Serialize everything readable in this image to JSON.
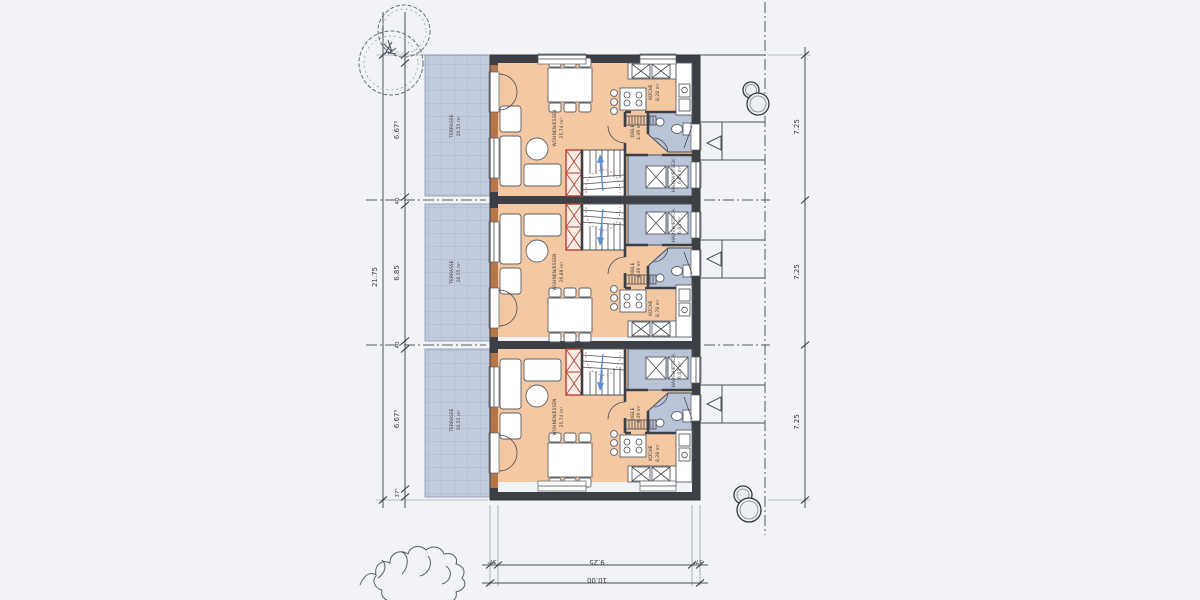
{
  "drawing": {
    "kind": "floor-plan-three-townhouse-units",
    "colors": {
      "paper": "#f1f3f6",
      "room_fill": "#f4c8a2",
      "wet_room_fill": "#bac4d9",
      "terrace_fill": "#c3cbde",
      "wall": "#3c3f45",
      "wall_wood": "#b5764a",
      "stair_accent_red": "#b4402e",
      "stair_arrow_blue": "#5b8fd4"
    },
    "units": [
      {
        "name": "unit-top",
        "rooms": [
          {
            "label": "WOHNEN/ESSEN",
            "area": "25,74 m²"
          },
          {
            "label": "KÜCHE",
            "area": "8,28 m²"
          },
          {
            "label": "DIELE",
            "area": "4,49 m²"
          },
          {
            "label": "HAUSWIRTSCH.",
            "area": "6,03 m²"
          },
          {
            "label": "TERRASSE",
            "area": "20,55 m²"
          }
        ]
      },
      {
        "name": "unit-middle",
        "rooms": [
          {
            "label": "WOHNEN/ESSEN",
            "area": "26,89 m²"
          },
          {
            "label": "KÜCHE",
            "area": "8,78 m²"
          },
          {
            "label": "DIELE",
            "area": "4,49 m²"
          },
          {
            "label": "HAUSWIRTSCH.",
            "area": "6,04 m²"
          },
          {
            "label": "TERRASSE",
            "area": "20,55 m²"
          }
        ]
      },
      {
        "name": "unit-bottom",
        "rooms": [
          {
            "label": "WOHNEN/ESSEN",
            "area": "25,74 m²"
          },
          {
            "label": "KÜCHE",
            "area": "8,28 m²"
          },
          {
            "label": "DIELE",
            "area": "4,49 m²"
          },
          {
            "label": "HAUSWIRTSCH.",
            "area": "6,03 m²"
          },
          {
            "label": "TERRASSE",
            "area": "20,55 m²"
          }
        ]
      }
    ],
    "dims": {
      "left_total": "21.75",
      "left_segments": [
        "6.67⁵",
        "40",
        "6.85",
        "40",
        "6.67⁵",
        "37⁵"
      ],
      "right_segments": [
        "7.25",
        "7.25",
        "7.25"
      ],
      "bottom_wall_left": "37⁵",
      "bottom_width": "9.25",
      "bottom_wall_right": "37⁵",
      "bottom_total": "10.00"
    }
  }
}
